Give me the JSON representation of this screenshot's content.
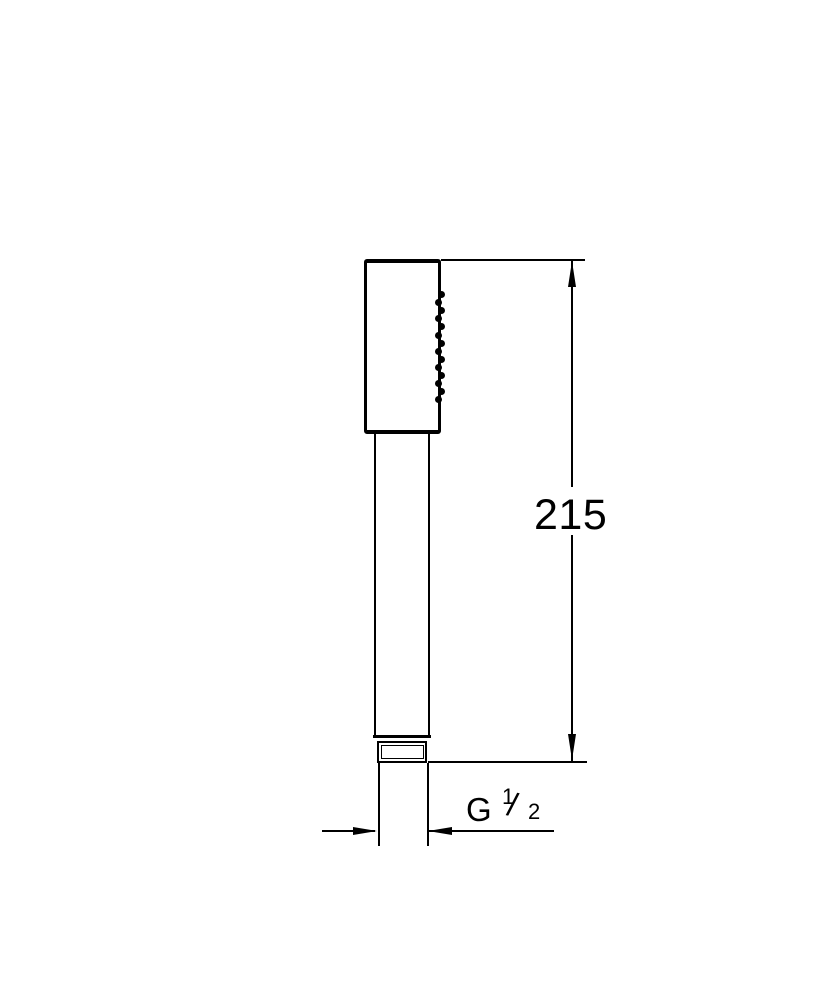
{
  "page": {
    "background": "#ffffff",
    "line_color": "#000000"
  },
  "dimensions": {
    "height": {
      "value": "215"
    },
    "thread": {
      "label": "G 1/2",
      "prefix": "G",
      "numerator": "1",
      "slash": "/",
      "denominator": "2"
    }
  },
  "spray": {
    "nozzle_count": 14
  }
}
